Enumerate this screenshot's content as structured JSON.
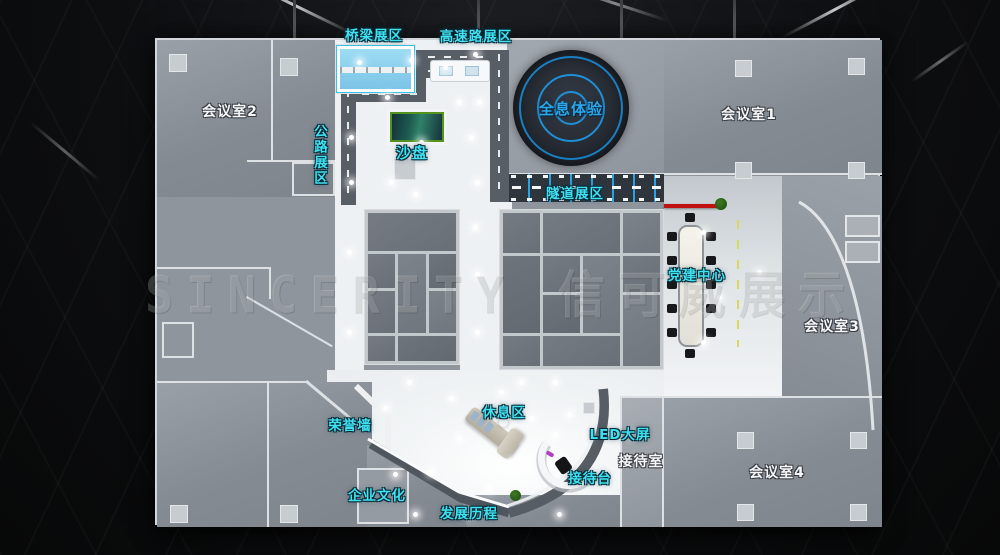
{
  "watermark": "SINCERITY 信可威展示",
  "labels": {
    "bridge": "桥梁展区",
    "highway": "高速路展区",
    "meeting2": "会议室2",
    "road_zone": "公路展区",
    "sand_table": "沙盘",
    "holography": "全息体验",
    "meeting1": "会议室1",
    "tunnel": "隧道展区",
    "party_center": "党建中心",
    "meeting3": "会议室3",
    "honor_wall": "荣誉墙",
    "rest_area": "休息区",
    "led_screen": "LED大屏",
    "reception_room": "接待室",
    "reception_desk": "接待台",
    "meeting4": "会议室4",
    "culture": "企业文化",
    "history": "发展历程"
  },
  "colors": {
    "label_cyan": "#3fe2f2",
    "label_white": "#f4f6f8",
    "holo_blue": "#2ba6e8",
    "red_wall": "#c01010",
    "road_gray": "#585e66",
    "floor_gray": "#8f959d",
    "atrium_white": "#f2f5f6"
  }
}
